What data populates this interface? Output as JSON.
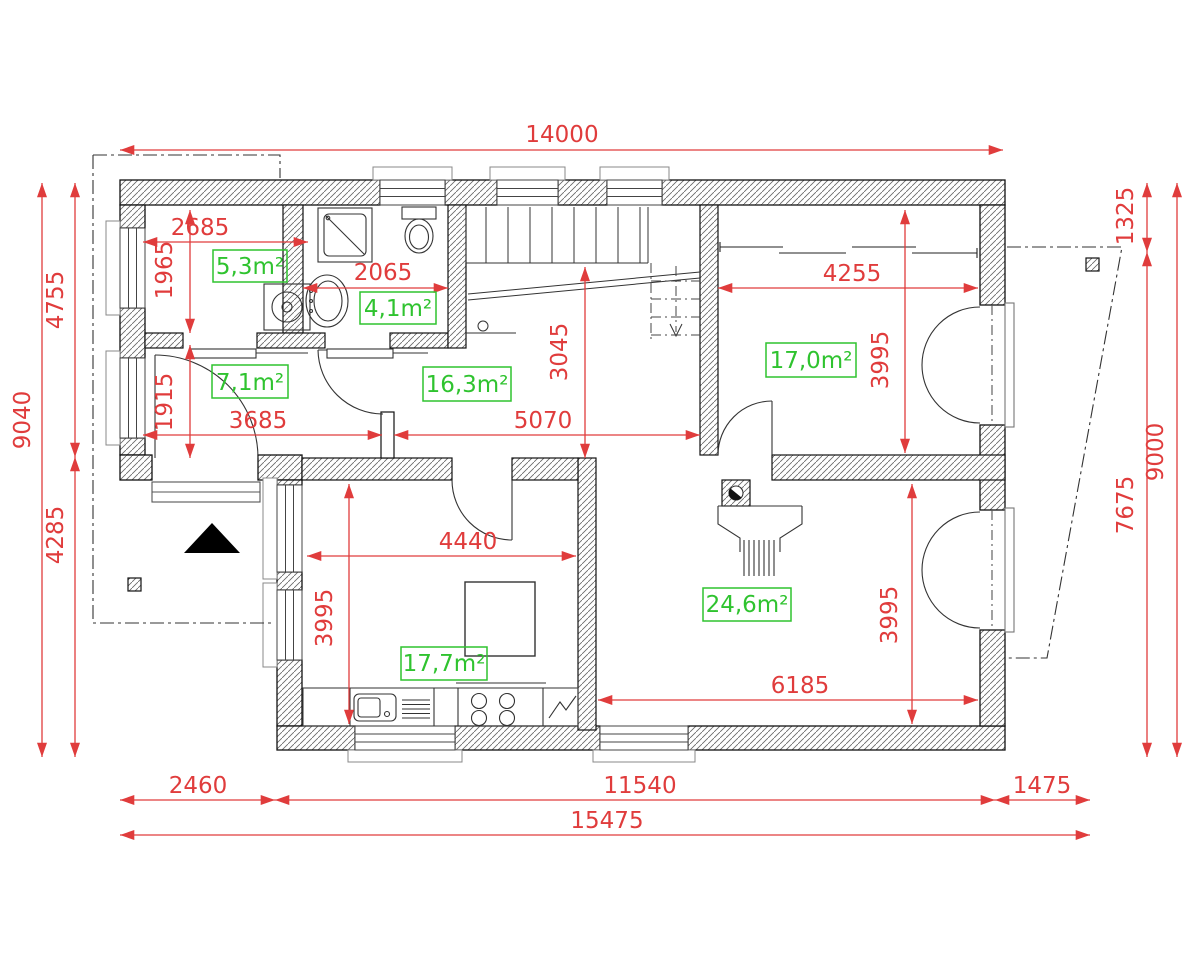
{
  "plan": {
    "dims": {
      "top_total": "14000",
      "left_total": "9040",
      "left_upper": "4755",
      "left_lower": "4285",
      "right_total": "9000",
      "right_upper": "1325",
      "right_lower": "7675",
      "bottom_left": "2460",
      "bottom_middle": "11540",
      "bottom_right": "1475",
      "bottom_total": "15475",
      "storage_width": "2685",
      "storage_height": "1965",
      "hall_small_height": "1915",
      "hall_small_width": "3685",
      "bath_width": "2065",
      "hall_height": "3045",
      "hall_width": "5070",
      "bedroom_width": "4255",
      "bedroom_height": "3995",
      "kitchen_width": "4440",
      "kitchen_height": "3995",
      "living_width": "6185",
      "living_height": "3995"
    },
    "areas": {
      "storage": "5,3m²",
      "bathroom": "4,1m²",
      "hall_small": "7,1m²",
      "hall": "16,3m²",
      "bedroom": "17,0m²",
      "kitchen": "17,7m²",
      "living": "24,6m²"
    },
    "colors": {
      "dimension": "#e03c3c",
      "area": "#2fc32f",
      "wall": "#111111"
    }
  }
}
